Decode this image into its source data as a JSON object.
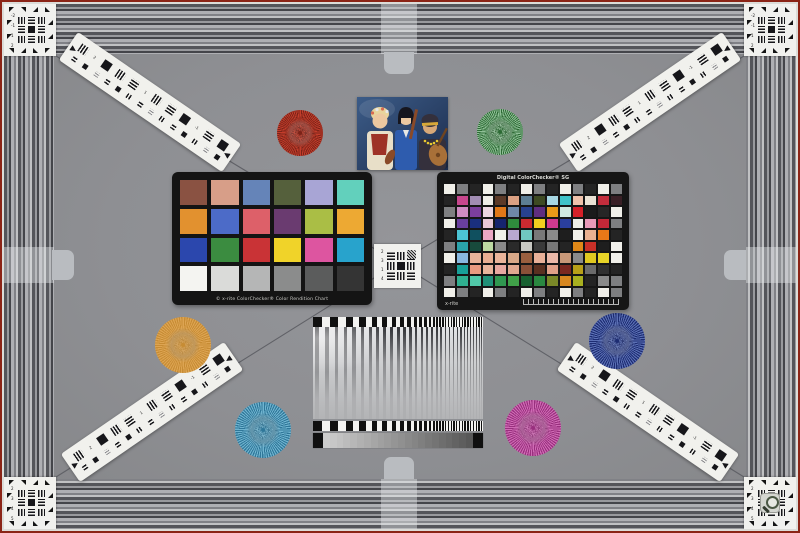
{
  "meta": {
    "background": "#8f9094",
    "frame_red": "#8b2416",
    "frame_white": "#dcdcd8",
    "tab_gray": "#b9bcc0"
  },
  "classic_chart": {
    "caption": "© x-rite ColorChecker® Color Rendition Chart",
    "rows": [
      [
        "#8a5242",
        "#d79e88",
        "#6584b8",
        "#55603c",
        "#a8a5d5",
        "#62d0bc"
      ],
      [
        "#e2912f",
        "#4c6bc8",
        "#dd6069",
        "#6a3b70",
        "#aabe45",
        "#eda933"
      ],
      [
        "#2b47ad",
        "#3b8c40",
        "#c93336",
        "#f0d329",
        "#dd55a0",
        "#28a3cc"
      ],
      [
        "#f4f4f1",
        "#dadbd9",
        "#b5b6b6",
        "#8b8c8c",
        "#5b5c5c",
        "#343434"
      ]
    ]
  },
  "sg_chart": {
    "title": "Digital ColorChecker® SG",
    "logo": "x-rite",
    "rows": [
      [
        "#f0efe9",
        "#7e7f81",
        "#242424",
        "#f0efe9",
        "#7e7f81",
        "#242424",
        "#f0efe9",
        "#7e7f81",
        "#242424",
        "#f0efe9",
        "#7e7f81",
        "#242424",
        "#f0efe9",
        "#7e7f81"
      ],
      [
        "#242424",
        "#c7468d",
        "#a18cb3",
        "#eeede7",
        "#5c3a28",
        "#dba183",
        "#5d7e94",
        "#3e4a22",
        "#a7d7e3",
        "#3fc3c9",
        "#efc2ab",
        "#e9e2d4",
        "#c22d3c",
        "#3a2026"
      ],
      [
        "#7e7f81",
        "#cf8cc3",
        "#7c3f9e",
        "#ecd6e2",
        "#e07818",
        "#6f88a8",
        "#28418f",
        "#5f2d80",
        "#e89a18",
        "#cfe8df",
        "#d42028",
        "#1b1b1b",
        "#262626",
        "#f0efe9"
      ],
      [
        "#f0efe9",
        "#6a3f9e",
        "#1a2f7e",
        "#e8c8d8",
        "#16246e",
        "#2f8c3c",
        "#cc2a30",
        "#f0ce1f",
        "#d03a8e",
        "#2a3f9e",
        "#eeeee8",
        "#e89ab8",
        "#c42838",
        "#7e7f81"
      ],
      [
        "#242424",
        "#4cc4d4",
        "#10505f",
        "#eaa6c4",
        "#f0f0ea",
        "#b8a8d0",
        "#70c8c0",
        "#787878",
        "#8a8a8a",
        "#1e1e1e",
        "#f0efe9",
        "#e8b090",
        "#e87818",
        "#242424"
      ],
      [
        "#7e7f81",
        "#2aa3ab",
        "#184a3c",
        "#bcd9a2",
        "#8a8a8a",
        "#2a2a2a",
        "#c8c8c2",
        "#3a3a3a",
        "#787878",
        "#242424",
        "#e08818",
        "#c83028",
        "#1e1e1e",
        "#f0efe9"
      ],
      [
        "#f0efe9",
        "#88b8e0",
        "#e8b49a",
        "#e8ae92",
        "#eab49a",
        "#d8a888",
        "#9a5f3f",
        "#e8b098",
        "#eab8a8",
        "#c89878",
        "#8a8a8a",
        "#e0c820",
        "#e8d428",
        "#f0efe9"
      ],
      [
        "#242424",
        "#18a098",
        "#e89a80",
        "#e8b49c",
        "#e8a8a0",
        "#e0a890",
        "#8a5038",
        "#5a3020",
        "#e0a088",
        "#7a2820",
        "#b8a018",
        "#6a6a6a",
        "#303030",
        "#242424"
      ],
      [
        "#7e7f81",
        "#30b090",
        "#50c8a8",
        "#209078",
        "#309850",
        "#40a048",
        "#186030",
        "#2a8840",
        "#7a8828",
        "#d88820",
        "#a8b020",
        "#242424",
        "#8a8a8a",
        "#7e7f81"
      ],
      [
        "#f0efe9",
        "#7e7f81",
        "#242424",
        "#f0efe9",
        "#7e7f81",
        "#242424",
        "#f0efe9",
        "#7e7f81",
        "#242424",
        "#f0efe9",
        "#7e7f81",
        "#242424",
        "#f0efe9",
        "#7e7f81"
      ]
    ]
  },
  "stars": [
    {
      "label": "red",
      "x": 300,
      "y": 133,
      "r": 23,
      "c1": "#c23d2b",
      "c2": "#7c2318"
    },
    {
      "label": "green",
      "x": 500,
      "y": 132,
      "r": 23,
      "c1": "#8fbf96",
      "c2": "#2d6b35"
    },
    {
      "label": "orange",
      "x": 183,
      "y": 345,
      "r": 28,
      "c1": "#dda452",
      "c2": "#c78c34"
    },
    {
      "label": "blue",
      "x": 617,
      "y": 341,
      "r": 28,
      "c1": "#5a6fb4",
      "c2": "#1d2c72"
    },
    {
      "label": "steel-blue",
      "x": 263,
      "y": 430,
      "r": 28,
      "c1": "#6fb3cf",
      "c2": "#2f7799"
    },
    {
      "label": "magenta",
      "x": 533,
      "y": 428,
      "r": 28,
      "c1": "#cf6ab4",
      "c2": "#99307e"
    }
  ],
  "strips": [
    {
      "cx": 150,
      "cy": 102,
      "angle": 34.5
    },
    {
      "cx": 650,
      "cy": 102,
      "angle": -34.5
    },
    {
      "cx": 152,
      "cy": 412,
      "angle": -34.5
    },
    {
      "cx": 648,
      "cy": 412,
      "angle": 34.5
    }
  ],
  "strip_labels": [
    "2",
    "1",
    "-1",
    "-2"
  ],
  "corners": [
    {
      "id": "tl",
      "x": 4,
      "y": 4,
      "labels": [
        "-2",
        "-1",
        "1",
        "2"
      ],
      "loupe": false
    },
    {
      "id": "tr",
      "x": 744,
      "y": 4,
      "labels": [
        "-2",
        "-1",
        "1",
        "2"
      ],
      "loupe": false
    },
    {
      "id": "bl",
      "x": 4,
      "y": 477,
      "labels": [
        "2",
        "3",
        "4",
        "5"
      ],
      "loupe": false
    },
    {
      "id": "br",
      "x": 744,
      "y": 477,
      "labels": [
        "2",
        "3",
        "4",
        "5"
      ],
      "loupe": true
    }
  ],
  "center_target": {
    "labels": [
      "2",
      "3",
      "1",
      "4"
    ]
  },
  "sweep": {
    "stripe_dark": "#3a3b3f",
    "checker_dark": "#101010",
    "checker_light": "#f3f3f1",
    "step_end": "#101010",
    "step_light": 205,
    "step_dark": 88,
    "steps": 24
  },
  "portrait": {
    "palette": {
      "bg1": "#3c5c88",
      "bg2": "#1c2c4c",
      "skin1": "#ecc8a0",
      "skin2": "#d8a878",
      "hair_blonde": "#e8d49c",
      "hair_black": "#16161e",
      "dress_cream": "#e8dfc8",
      "bodice_red": "#9e3226",
      "dress_blue": "#2e5cae",
      "collar_white": "#e8e8e4",
      "scarf_dark": "#34303c",
      "scarf_gold": "#d8a838",
      "necklace": "#e8c830",
      "lute": "#a87038",
      "lute_dark": "#6e4420",
      "violin": "#8a4a28",
      "flower1": "#d86a50",
      "flower2": "#e8e8e8"
    }
  },
  "loupe": {
    "ring": "#4a5844",
    "handle": "#343c30"
  }
}
